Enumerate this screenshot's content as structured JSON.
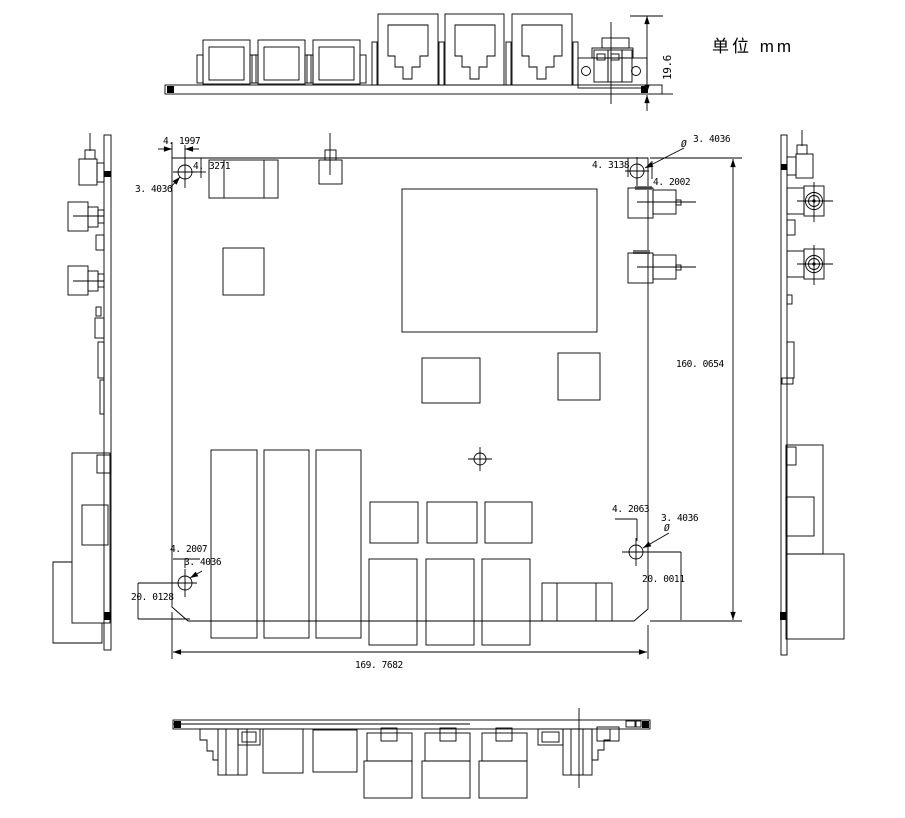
{
  "drawing": {
    "units_label": "单位 mm",
    "dims": {
      "panel_height": "19.6",
      "board_width": "169. 7682",
      "board_height": "160. 0654",
      "hole_tl_x": "4. 1997",
      "hole_tl_y": "4. 3271",
      "hole_tl_dia": "3. 4036",
      "hole_tr_y": "4. 3138",
      "hole_tr_dia": "3. 4036",
      "hole_tr_dia_symbol": "Ø",
      "sma_offset_y": "4. 2002",
      "hole_br_x": "4. 2063",
      "hole_br_dia": "3. 4036",
      "hole_br_dia_symbol": "Ø",
      "hole_br_bottom": "20. 0011",
      "hole_bl_x": "4. 2007",
      "hole_bl_dia": "3. 4036",
      "hole_bl_bottom": "20. 0128"
    }
  }
}
